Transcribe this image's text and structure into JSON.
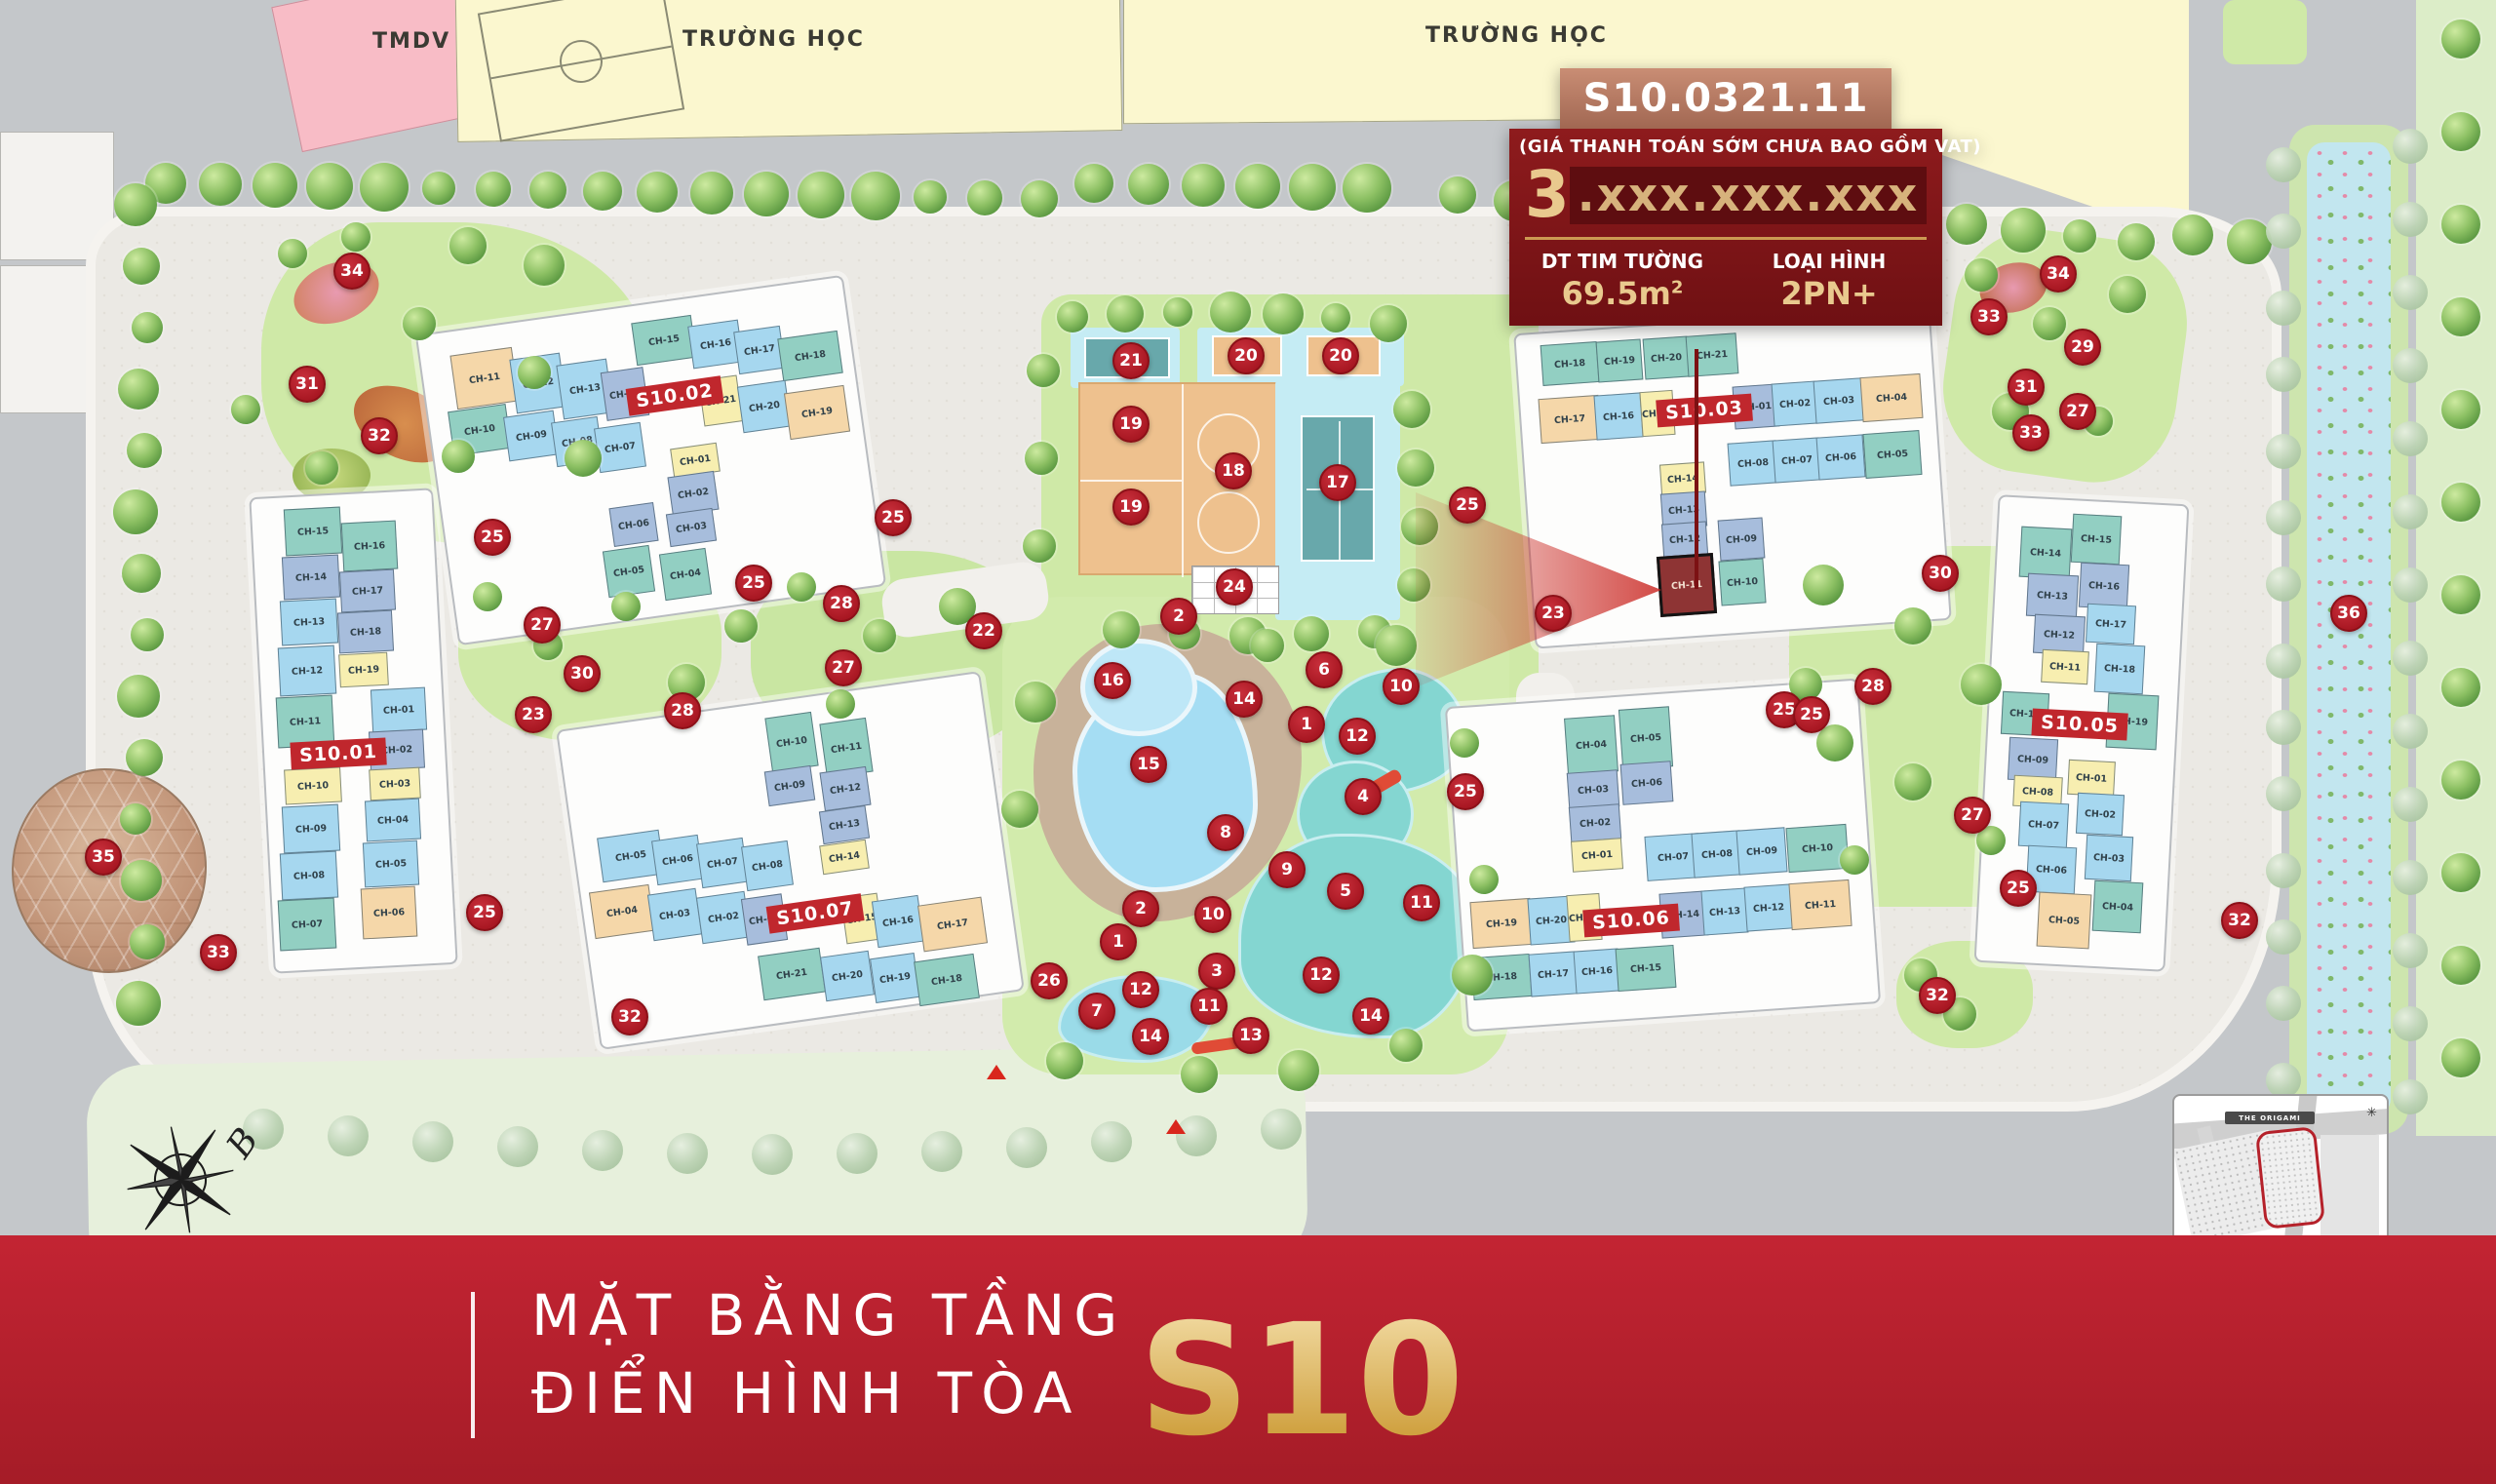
{
  "map_labels": {
    "tmdv": "TMDV",
    "school1": "TRƯỜNG HỌC",
    "school2": "TRƯỜNG HỌC",
    "inset_title": "THE ORIGAMI",
    "compass_letter": "B"
  },
  "info_box": {
    "unit_code": "S10.0321.11",
    "price_note": "(GIÁ THANH TOÁN SỚM CHƯA BAO GỒM VAT)",
    "price_lead": "3",
    "price_masked": ".xxx.xxx.xxx",
    "area_label": "DT TIM TƯỜNG",
    "area_value": "69.5m",
    "area_sup": "2",
    "type_label": "LOẠI HÌNH",
    "type_value": "2PN+"
  },
  "title_banner": {
    "line1": "MẶT BẰNG TẦNG",
    "line2": "ĐIỂN HÌNH TÒA",
    "tower": "S10"
  },
  "highlight": {
    "building": "S10.03",
    "unit": "CH-11"
  },
  "colors": {
    "accent_red": "#c0272d",
    "marker_red": "#a81722",
    "gold": "#e9c98e",
    "teal_unit": "#92cfc2",
    "blue_unit": "#a6d7ef",
    "periwinkle_unit": "#a7bddc",
    "yellow_unit": "#f7eeb0",
    "tan_unit": "#f5d7a9",
    "highlight_unit": "#8e3434"
  },
  "buildings": [
    {
      "id": "S10.01",
      "label": "S10.01",
      "label_x": 347,
      "label_y": 773,
      "rot": -3,
      "units": [
        [
          "CH-15",
          321,
          545,
          58,
          48,
          "t"
        ],
        [
          "CH-14",
          319,
          592,
          58,
          44,
          "p"
        ],
        [
          "CH-13",
          317,
          638,
          58,
          46,
          "b"
        ],
        [
          "CH-12",
          315,
          688,
          58,
          50,
          "b"
        ],
        [
          "CH-11",
          313,
          740,
          58,
          52,
          "t"
        ],
        [
          "CH-10",
          321,
          806,
          58,
          36,
          "y"
        ],
        [
          "CH-09",
          319,
          850,
          58,
          48,
          "b"
        ],
        [
          "CH-08",
          317,
          898,
          58,
          48,
          "b"
        ],
        [
          "CH-07",
          315,
          948,
          58,
          52,
          "t"
        ],
        [
          "CH-16",
          379,
          560,
          56,
          50,
          "t"
        ],
        [
          "CH-17",
          377,
          606,
          56,
          42,
          "p"
        ],
        [
          "CH-18",
          375,
          648,
          56,
          42,
          "p"
        ],
        [
          "CH-19",
          373,
          687,
          50,
          34,
          "y"
        ],
        [
          "CH-01",
          409,
          728,
          56,
          44,
          "b"
        ],
        [
          "CH-02",
          407,
          769,
          56,
          40,
          "p"
        ],
        [
          "CH-03",
          405,
          804,
          52,
          32,
          "y"
        ],
        [
          "CH-04",
          403,
          841,
          56,
          42,
          "b"
        ],
        [
          "CH-05",
          401,
          886,
          56,
          46,
          "b"
        ],
        [
          "CH-06",
          399,
          936,
          56,
          52,
          "o"
        ]
      ]
    },
    {
      "id": "S10.02",
      "label": "S10.02",
      "label_x": 692,
      "label_y": 406,
      "rot": -8,
      "units": [
        [
          "CH-11",
          497,
          388,
          64,
          56,
          "o"
        ],
        [
          "CH-12",
          552,
          393,
          52,
          56,
          "b"
        ],
        [
          "CH-13",
          600,
          399,
          52,
          56,
          "b"
        ],
        [
          "CH-14",
          641,
          404,
          44,
          50,
          "p"
        ],
        [
          "CH-10",
          492,
          441,
          60,
          46,
          "t"
        ],
        [
          "CH-09",
          545,
          447,
          52,
          46,
          "b"
        ],
        [
          "CH-08",
          592,
          453,
          48,
          46,
          "b"
        ],
        [
          "CH-07",
          636,
          459,
          48,
          46,
          "b"
        ],
        [
          "CH-15",
          681,
          349,
          62,
          44,
          "t"
        ],
        [
          "CH-16",
          734,
          353,
          52,
          44,
          "b"
        ],
        [
          "CH-17",
          779,
          359,
          48,
          44,
          "b"
        ],
        [
          "CH-18",
          831,
          365,
          62,
          44,
          "t"
        ],
        [
          "CH-21",
          739,
          411,
          40,
          48,
          "y"
        ],
        [
          "CH-20",
          784,
          417,
          50,
          48,
          "b"
        ],
        [
          "CH-19",
          838,
          423,
          62,
          48,
          "o"
        ],
        [
          "CH-01",
          713,
          472,
          48,
          30,
          "y"
        ],
        [
          "CH-02",
          711,
          506,
          48,
          40,
          "p"
        ],
        [
          "CH-03",
          709,
          541,
          48,
          34,
          "p"
        ],
        [
          "CH-06",
          650,
          538,
          46,
          40,
          "p"
        ],
        [
          "CH-05",
          645,
          586,
          48,
          48,
          "t"
        ],
        [
          "CH-04",
          703,
          589,
          48,
          48,
          "t"
        ]
      ]
    },
    {
      "id": "S10.03",
      "label": "S10.03",
      "label_x": 1748,
      "label_y": 421,
      "rot": -4,
      "units": [
        [
          "CH-18",
          1610,
          373,
          58,
          42,
          "t"
        ],
        [
          "CH-19",
          1661,
          370,
          46,
          42,
          "t"
        ],
        [
          "CH-20",
          1709,
          367,
          46,
          42,
          "t"
        ],
        [
          "CH-21",
          1756,
          364,
          52,
          42,
          "t"
        ],
        [
          "CH-17",
          1610,
          430,
          62,
          46,
          "o"
        ],
        [
          "CH-16",
          1660,
          427,
          48,
          46,
          "b"
        ],
        [
          "CH-15",
          1700,
          424,
          34,
          46,
          "y"
        ],
        [
          "CH-01",
          1801,
          417,
          46,
          44,
          "p"
        ],
        [
          "CH-02",
          1841,
          414,
          46,
          44,
          "b"
        ],
        [
          "CH-03",
          1886,
          411,
          50,
          44,
          "b"
        ],
        [
          "CH-04",
          1940,
          408,
          62,
          46,
          "o"
        ],
        [
          "CH-08",
          1798,
          475,
          50,
          44,
          "b"
        ],
        [
          "CH-07",
          1843,
          472,
          48,
          44,
          "b"
        ],
        [
          "CH-06",
          1888,
          469,
          48,
          44,
          "b"
        ],
        [
          "CH-05",
          1941,
          466,
          58,
          46,
          "t"
        ],
        [
          "CH-14",
          1726,
          491,
          46,
          32,
          "y"
        ],
        [
          "CH-13",
          1727,
          523,
          46,
          36,
          "p"
        ],
        [
          "CH-12",
          1728,
          553,
          46,
          34,
          "p"
        ],
        [
          "CH-11",
          1730,
          600,
          58,
          62,
          "H"
        ],
        [
          "CH-09",
          1786,
          553,
          46,
          42,
          "p"
        ],
        [
          "CH-10",
          1787,
          597,
          46,
          46,
          "t"
        ]
      ]
    },
    {
      "id": "S10.05",
      "label": "S10.05",
      "label_x": 2133,
      "label_y": 743,
      "rot": 3,
      "units": [
        [
          "CH-14",
          2098,
          567,
          52,
          52,
          "t"
        ],
        [
          "CH-13",
          2105,
          611,
          52,
          44,
          "p"
        ],
        [
          "CH-12",
          2112,
          651,
          52,
          40,
          "p"
        ],
        [
          "CH-11",
          2118,
          684,
          48,
          34,
          "y"
        ],
        [
          "CH-10",
          2077,
          732,
          48,
          44,
          "t"
        ],
        [
          "CH-09",
          2085,
          779,
          50,
          44,
          "p"
        ],
        [
          "CH-08",
          2090,
          812,
          50,
          32,
          "y"
        ],
        [
          "CH-07",
          2096,
          846,
          50,
          46,
          "b"
        ],
        [
          "CH-06",
          2104,
          892,
          50,
          48,
          "b"
        ],
        [
          "CH-05",
          2117,
          944,
          54,
          56,
          "o"
        ],
        [
          "CH-15",
          2150,
          553,
          50,
          50,
          "t"
        ],
        [
          "CH-16",
          2158,
          601,
          50,
          46,
          "p"
        ],
        [
          "CH-17",
          2165,
          640,
          50,
          40,
          "b"
        ],
        [
          "CH-18",
          2174,
          686,
          50,
          50,
          "b"
        ],
        [
          "CH-19",
          2187,
          740,
          52,
          56,
          "t"
        ],
        [
          "CH-01",
          2145,
          798,
          48,
          36,
          "y"
        ],
        [
          "CH-02",
          2154,
          835,
          48,
          42,
          "b"
        ],
        [
          "CH-03",
          2163,
          880,
          48,
          46,
          "b"
        ],
        [
          "CH-04",
          2172,
          930,
          50,
          52,
          "t"
        ]
      ]
    },
    {
      "id": "S10.06",
      "label": "S10.06",
      "label_x": 1673,
      "label_y": 944,
      "rot": -4,
      "units": [
        [
          "CH-04",
          1632,
          764,
          52,
          58,
          "t"
        ],
        [
          "CH-05",
          1688,
          757,
          52,
          62,
          "t"
        ],
        [
          "CH-03",
          1634,
          810,
          52,
          38,
          "p"
        ],
        [
          "CH-06",
          1689,
          803,
          52,
          42,
          "p"
        ],
        [
          "CH-02",
          1636,
          844,
          52,
          36,
          "p"
        ],
        [
          "CH-01",
          1638,
          877,
          52,
          32,
          "y"
        ],
        [
          "CH-07",
          1716,
          879,
          56,
          46,
          "b"
        ],
        [
          "CH-08",
          1761,
          876,
          50,
          46,
          "b"
        ],
        [
          "CH-09",
          1807,
          873,
          50,
          46,
          "b"
        ],
        [
          "CH-10",
          1864,
          870,
          62,
          46,
          "t"
        ],
        [
          "CH-19",
          1540,
          947,
          62,
          48,
          "o"
        ],
        [
          "CH-20",
          1591,
          944,
          46,
          48,
          "b"
        ],
        [
          "CH-21",
          1625,
          941,
          34,
          48,
          "y"
        ],
        [
          "CH-14",
          1727,
          938,
          48,
          46,
          "p"
        ],
        [
          "CH-13",
          1769,
          935,
          46,
          46,
          "b"
        ],
        [
          "CH-12",
          1814,
          931,
          48,
          46,
          "b"
        ],
        [
          "CH-11",
          1867,
          928,
          62,
          48,
          "o"
        ],
        [
          "CH-18",
          1540,
          1002,
          60,
          44,
          "t"
        ],
        [
          "CH-17",
          1593,
          999,
          48,
          44,
          "b"
        ],
        [
          "CH-16",
          1638,
          996,
          46,
          44,
          "b"
        ],
        [
          "CH-15",
          1688,
          993,
          60,
          44,
          "t"
        ]
      ]
    },
    {
      "id": "S10.07",
      "label": "S10.07",
      "label_x": 836,
      "label_y": 937,
      "rot": -8,
      "units": [
        [
          "CH-10",
          812,
          761,
          48,
          56,
          "t"
        ],
        [
          "CH-11",
          868,
          767,
          48,
          56,
          "t"
        ],
        [
          "CH-09",
          810,
          806,
          48,
          36,
          "p"
        ],
        [
          "CH-12",
          867,
          809,
          48,
          40,
          "p"
        ],
        [
          "CH-13",
          866,
          846,
          48,
          34,
          "p"
        ],
        [
          "CH-14",
          866,
          879,
          48,
          30,
          "y"
        ],
        [
          "CH-05",
          647,
          878,
          64,
          46,
          "b"
        ],
        [
          "CH-06",
          695,
          882,
          48,
          46,
          "b"
        ],
        [
          "CH-07",
          741,
          885,
          48,
          46,
          "b"
        ],
        [
          "CH-08",
          787,
          888,
          48,
          46,
          "b"
        ],
        [
          "CH-04",
          638,
          935,
          62,
          48,
          "o"
        ],
        [
          "CH-03",
          692,
          938,
          50,
          48,
          "b"
        ],
        [
          "CH-02",
          742,
          941,
          50,
          48,
          "b"
        ],
        [
          "CH-01",
          784,
          943,
          42,
          48,
          "p"
        ],
        [
          "CH-15",
          884,
          942,
          38,
          48,
          "y"
        ],
        [
          "CH-16",
          921,
          945,
          48,
          48,
          "b"
        ],
        [
          "CH-17",
          977,
          948,
          66,
          48,
          "o"
        ],
        [
          "CH-21",
          812,
          999,
          64,
          46,
          "t"
        ],
        [
          "CH-20",
          869,
          1001,
          50,
          46,
          "b"
        ],
        [
          "CH-19",
          918,
          1003,
          46,
          46,
          "b"
        ],
        [
          "CH-18",
          971,
          1005,
          62,
          46,
          "t"
        ]
      ]
    }
  ],
  "markers": [
    [
      34,
      361,
      278
    ],
    [
      31,
      315,
      394
    ],
    [
      32,
      389,
      447
    ],
    [
      25,
      505,
      551
    ],
    [
      27,
      556,
      641
    ],
    [
      30,
      597,
      691
    ],
    [
      23,
      547,
      733
    ],
    [
      28,
      700,
      729
    ],
    [
      25,
      773,
      598
    ],
    [
      28,
      863,
      619
    ],
    [
      27,
      865,
      685
    ],
    [
      22,
      1009,
      647
    ],
    [
      25,
      916,
      531
    ],
    [
      35,
      106,
      879
    ],
    [
      33,
      224,
      977
    ],
    [
      25,
      497,
      936
    ],
    [
      32,
      646,
      1043
    ],
    [
      21,
      1160,
      370
    ],
    [
      20,
      1278,
      365
    ],
    [
      20,
      1375,
      365
    ],
    [
      19,
      1160,
      435
    ],
    [
      19,
      1160,
      520
    ],
    [
      18,
      1265,
      483
    ],
    [
      17,
      1372,
      495
    ],
    [
      24,
      1266,
      602
    ],
    [
      25,
      1505,
      518
    ],
    [
      23,
      1593,
      629
    ],
    [
      16,
      1141,
      698
    ],
    [
      15,
      1178,
      784
    ],
    [
      2,
      1209,
      632
    ],
    [
      14,
      1276,
      717
    ],
    [
      6,
      1358,
      687
    ],
    [
      1,
      1340,
      743
    ],
    [
      12,
      1392,
      755
    ],
    [
      10,
      1437,
      704
    ],
    [
      4,
      1398,
      817
    ],
    [
      8,
      1257,
      854
    ],
    [
      9,
      1320,
      892
    ],
    [
      5,
      1380,
      914
    ],
    [
      11,
      1458,
      926
    ],
    [
      25,
      1503,
      812
    ],
    [
      10,
      1244,
      938
    ],
    [
      2,
      1170,
      932
    ],
    [
      1,
      1147,
      966
    ],
    [
      3,
      1248,
      996
    ],
    [
      12,
      1355,
      1000
    ],
    [
      14,
      1406,
      1042
    ],
    [
      13,
      1283,
      1062
    ],
    [
      11,
      1240,
      1032
    ],
    [
      12,
      1170,
      1015
    ],
    [
      7,
      1125,
      1037
    ],
    [
      14,
      1180,
      1063
    ],
    [
      26,
      1076,
      1006
    ],
    [
      25,
      1830,
      728
    ],
    [
      30,
      1990,
      588
    ],
    [
      28,
      1921,
      704
    ],
    [
      25,
      1858,
      733
    ],
    [
      27,
      2023,
      836
    ],
    [
      25,
      2070,
      911
    ],
    [
      32,
      1987,
      1021
    ],
    [
      34,
      2111,
      281
    ],
    [
      33,
      2040,
      325
    ],
    [
      29,
      2136,
      356
    ],
    [
      31,
      2078,
      397
    ],
    [
      27,
      2131,
      422
    ],
    [
      33,
      2083,
      444
    ],
    [
      36,
      2409,
      629
    ],
    [
      32,
      2297,
      944
    ]
  ]
}
